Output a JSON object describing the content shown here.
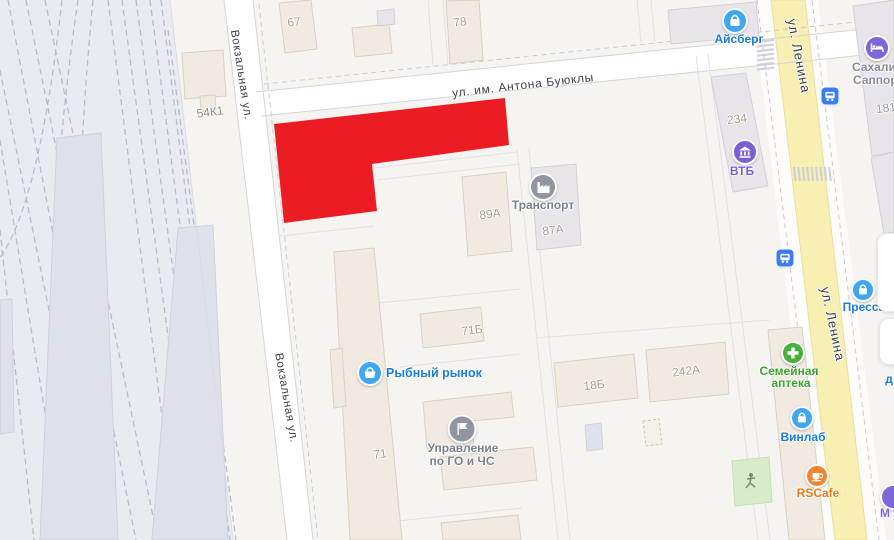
{
  "palette": {
    "highlight_red": "#ec1c24",
    "road_yellow": "#f8efb2",
    "railway_bg": "#e9ebf1",
    "land": "#f6f4f1",
    "building_beige": "#f0eae1",
    "building_gray": "#e7e5e9",
    "poi_blue": "#3fa6f3",
    "poi_blue_label": "#1a7cd8",
    "poi_green": "#47b23b",
    "poi_green_label": "#3ba32c",
    "poi_orange": "#f2862e",
    "poi_orange_label": "#ea7918",
    "poi_purple": "#7d66d9",
    "poi_gray": "#8f96a1",
    "poi_gray_label": "#7a818c",
    "hotel_label": "#8d87a3",
    "transit_blue": "#3b7cee"
  },
  "streets": {
    "vokzalnaya": "Вокзальная ул.",
    "buyukly": "ул. им. Антона Буюклы",
    "lenina": "ул. Ленина"
  },
  "buildings": {
    "b67": "67",
    "b78": "78",
    "b54k1": "54К1",
    "b89a": "89А",
    "b87a": "87А",
    "b71b": "71Б",
    "b71": "71",
    "b18b": "18Б",
    "b242a": "242А",
    "b234": "234",
    "b181": "181"
  },
  "pois": {
    "aisberg": {
      "label": "Айсберг",
      "icon": "shopping-bag"
    },
    "hotel": {
      "line1": "Сахали",
      "line2": "Саппор",
      "icon": "bed"
    },
    "vtb": {
      "label": "ВТБ",
      "icon": "bank"
    },
    "transport": {
      "label": "Транспорт",
      "icon": "factory"
    },
    "fish_market": {
      "label": "Рыбный рынок",
      "icon": "basket"
    },
    "emergency": {
      "line1": "Управление",
      "line2": "по ГО и ЧС",
      "icon": "flag"
    },
    "pharmacy": {
      "line1": "Семейная",
      "line2": "аптека",
      "icon": "plus"
    },
    "vinlab": {
      "label": "Винлаб",
      "icon": "shopping-bag"
    },
    "rscafe": {
      "label": "RSCafe",
      "icon": "coffee-cup"
    },
    "pressa": {
      "label": "Пресса",
      "icon": "shopping-bag"
    },
    "clipped_label_d": "д",
    "clipped_label_m": "М"
  }
}
